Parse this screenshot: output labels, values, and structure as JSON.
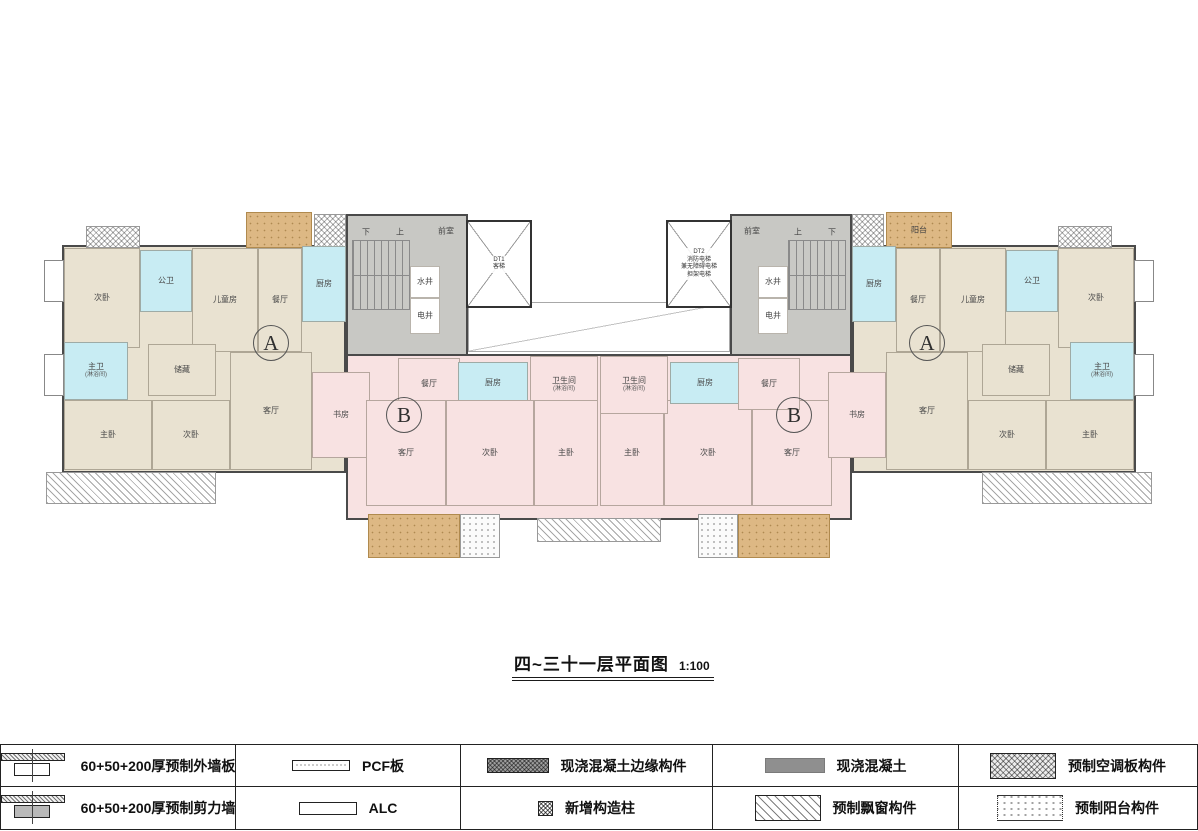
{
  "title": {
    "text": "四~三十一层平面图",
    "scale": "1:100"
  },
  "colors": {
    "beige": "#e9e2d1",
    "pink": "#f8e2e2",
    "cyan": "#c8ecf3",
    "gray": "#c8c8c4",
    "tan": "#ddb884",
    "white": "#ffffff",
    "wall": "#4a4a4a"
  },
  "plan": {
    "zones": [
      {
        "x": 62,
        "y": 245,
        "w": 284,
        "h": 228,
        "fill": "beige"
      },
      {
        "x": 852,
        "y": 245,
        "w": 284,
        "h": 228,
        "fill": "beige"
      },
      {
        "x": 346,
        "y": 214,
        "w": 122,
        "h": 146,
        "fill": "gray"
      },
      {
        "x": 730,
        "y": 214,
        "w": 122,
        "h": 146,
        "fill": "gray"
      },
      {
        "x": 346,
        "y": 354,
        "w": 506,
        "h": 166,
        "fill": "pink"
      }
    ],
    "rooms": [
      {
        "label": "次卧",
        "x": 64,
        "y": 248,
        "w": 76,
        "h": 100,
        "fill": "beige"
      },
      {
        "label": "公卫",
        "x": 140,
        "y": 250,
        "w": 52,
        "h": 62,
        "fill": "cyan"
      },
      {
        "label": "儿童房",
        "x": 192,
        "y": 248,
        "w": 66,
        "h": 104,
        "fill": "beige"
      },
      {
        "label": "餐厅",
        "x": 258,
        "y": 248,
        "w": 44,
        "h": 104,
        "fill": "beige"
      },
      {
        "label": "厨房",
        "x": 302,
        "y": 246,
        "w": 44,
        "h": 76,
        "fill": "cyan"
      },
      {
        "label": "主卫",
        "sub": "(淋浴间)",
        "x": 64,
        "y": 342,
        "w": 64,
        "h": 58,
        "fill": "cyan"
      },
      {
        "label": "储藏",
        "x": 148,
        "y": 344,
        "w": 68,
        "h": 52,
        "fill": "beige"
      },
      {
        "label": "主卧",
        "x": 64,
        "y": 400,
        "w": 88,
        "h": 70,
        "fill": "beige"
      },
      {
        "label": "次卧",
        "x": 152,
        "y": 400,
        "w": 78,
        "h": 70,
        "fill": "beige"
      },
      {
        "label": "客厅",
        "x": 230,
        "y": 352,
        "w": 82,
        "h": 118,
        "fill": "beige"
      },
      {
        "label": "书房",
        "x": 312,
        "y": 372,
        "w": 58,
        "h": 86,
        "fill": "pink"
      },
      {
        "label": "餐厅",
        "x": 398,
        "y": 358,
        "w": 62,
        "h": 52,
        "fill": "pink"
      },
      {
        "label": "厨房",
        "x": 458,
        "y": 362,
        "w": 70,
        "h": 42,
        "fill": "cyan"
      },
      {
        "label": "卫生间",
        "sub": "(淋浴间)",
        "x": 530,
        "y": 356,
        "w": 68,
        "h": 58,
        "fill": "pink"
      },
      {
        "label": "客厅",
        "x": 366,
        "y": 400,
        "w": 80,
        "h": 106,
        "fill": "pink"
      },
      {
        "label": "次卧",
        "x": 446,
        "y": 400,
        "w": 88,
        "h": 106,
        "fill": "pink"
      },
      {
        "label": "主卧",
        "x": 534,
        "y": 400,
        "w": 64,
        "h": 106,
        "fill": "pink"
      },
      {
        "label": "主卧",
        "x": 600,
        "y": 400,
        "w": 64,
        "h": 106,
        "fill": "pink"
      },
      {
        "label": "次卧",
        "x": 664,
        "y": 400,
        "w": 88,
        "h": 106,
        "fill": "pink"
      },
      {
        "label": "客厅",
        "x": 752,
        "y": 400,
        "w": 80,
        "h": 106,
        "fill": "pink"
      },
      {
        "label": "卫生间",
        "sub": "(淋浴间)",
        "x": 600,
        "y": 356,
        "w": 68,
        "h": 58,
        "fill": "pink"
      },
      {
        "label": "厨房",
        "x": 670,
        "y": 362,
        "w": 70,
        "h": 42,
        "fill": "cyan"
      },
      {
        "label": "餐厅",
        "x": 738,
        "y": 358,
        "w": 62,
        "h": 52,
        "fill": "pink"
      },
      {
        "label": "书房",
        "x": 828,
        "y": 372,
        "w": 58,
        "h": 86,
        "fill": "pink"
      },
      {
        "label": "厨房",
        "x": 852,
        "y": 246,
        "w": 44,
        "h": 76,
        "fill": "cyan"
      },
      {
        "label": "餐厅",
        "x": 896,
        "y": 248,
        "w": 44,
        "h": 104,
        "fill": "beige"
      },
      {
        "label": "儿童房",
        "x": 940,
        "y": 248,
        "w": 66,
        "h": 104,
        "fill": "beige"
      },
      {
        "label": "公卫",
        "x": 1006,
        "y": 250,
        "w": 52,
        "h": 62,
        "fill": "cyan"
      },
      {
        "label": "次卧",
        "x": 1058,
        "y": 248,
        "w": 76,
        "h": 100,
        "fill": "beige"
      },
      {
        "label": "客厅",
        "x": 886,
        "y": 352,
        "w": 82,
        "h": 118,
        "fill": "beige"
      },
      {
        "label": "储藏",
        "x": 982,
        "y": 344,
        "w": 68,
        "h": 52,
        "fill": "beige"
      },
      {
        "label": "主卫",
        "sub": "(淋浴间)",
        "x": 1070,
        "y": 342,
        "w": 64,
        "h": 58,
        "fill": "cyan"
      },
      {
        "label": "次卧",
        "x": 968,
        "y": 400,
        "w": 78,
        "h": 70,
        "fill": "beige"
      },
      {
        "label": "主卧",
        "x": 1046,
        "y": 400,
        "w": 88,
        "h": 70,
        "fill": "beige"
      },
      {
        "label": "水井",
        "x": 410,
        "y": 266,
        "w": 30,
        "h": 32,
        "fill": "white"
      },
      {
        "label": "电井",
        "x": 410,
        "y": 298,
        "w": 30,
        "h": 36,
        "fill": "white"
      },
      {
        "label": "水井",
        "x": 758,
        "y": 266,
        "w": 30,
        "h": 32,
        "fill": "white"
      },
      {
        "label": "电井",
        "x": 758,
        "y": 298,
        "w": 30,
        "h": 36,
        "fill": "white"
      }
    ],
    "patches": [
      {
        "type": "stairs",
        "x": 352,
        "y": 240,
        "w": 58,
        "h": 70
      },
      {
        "type": "stairs",
        "x": 788,
        "y": 240,
        "w": 58,
        "h": 70
      },
      {
        "type": "lightwell",
        "x": 468,
        "y": 302,
        "w": 262,
        "h": 50
      },
      {
        "type": "balcony-tan",
        "x": 246,
        "y": 212,
        "w": 66,
        "h": 36
      },
      {
        "type": "balcony-tan",
        "x": 886,
        "y": 212,
        "w": 66,
        "h": 36
      },
      {
        "type": "balcony-tan",
        "x": 368,
        "y": 514,
        "w": 92,
        "h": 44
      },
      {
        "type": "balcony-tan",
        "x": 738,
        "y": 514,
        "w": 92,
        "h": 44
      },
      {
        "type": "dots-white",
        "x": 460,
        "y": 514,
        "w": 40,
        "h": 44
      },
      {
        "type": "dots-white",
        "x": 698,
        "y": 514,
        "w": 40,
        "h": 44
      },
      {
        "type": "crosshatch",
        "x": 86,
        "y": 226,
        "w": 54,
        "h": 22
      },
      {
        "type": "crosshatch",
        "x": 1058,
        "y": 226,
        "w": 54,
        "h": 22
      },
      {
        "type": "crosshatch",
        "x": 314,
        "y": 214,
        "w": 32,
        "h": 34
      },
      {
        "type": "crosshatch",
        "x": 852,
        "y": 214,
        "w": 32,
        "h": 34
      },
      {
        "type": "bay",
        "x": 44,
        "y": 260,
        "w": 20,
        "h": 42
      },
      {
        "type": "bay",
        "x": 44,
        "y": 354,
        "w": 20,
        "h": 42
      },
      {
        "type": "bay",
        "x": 1134,
        "y": 260,
        "w": 20,
        "h": 42
      },
      {
        "type": "bay",
        "x": 1134,
        "y": 354,
        "w": 20,
        "h": 42
      },
      {
        "type": "diag",
        "x": 46,
        "y": 472,
        "w": 170,
        "h": 32
      },
      {
        "type": "diag",
        "x": 982,
        "y": 472,
        "w": 170,
        "h": 32
      },
      {
        "type": "diag",
        "x": 537,
        "y": 518,
        "w": 124,
        "h": 24
      }
    ],
    "elevators": [
      {
        "x": 466,
        "y": 220,
        "w": 66,
        "h": 88,
        "lines": [
          "DT1",
          "客梯"
        ]
      },
      {
        "x": 666,
        "y": 220,
        "w": 66,
        "h": 88,
        "lines": [
          "DT2",
          "消防电梯",
          "兼无障碍电梯",
          "担架电梯"
        ]
      }
    ],
    "labels": [
      {
        "text": "前室",
        "x": 446,
        "y": 231
      },
      {
        "text": "前室",
        "x": 752,
        "y": 231
      },
      {
        "text": "下",
        "x": 366,
        "y": 232
      },
      {
        "text": "上",
        "x": 400,
        "y": 232
      },
      {
        "text": "上",
        "x": 798,
        "y": 232
      },
      {
        "text": "下",
        "x": 832,
        "y": 232
      },
      {
        "text": "阳台",
        "x": 919,
        "y": 230
      }
    ],
    "units": [
      {
        "letter": "A",
        "cx": 271,
        "cy": 343
      },
      {
        "letter": "A",
        "cx": 927,
        "cy": 343
      },
      {
        "letter": "B",
        "cx": 404,
        "cy": 415
      },
      {
        "letter": "B",
        "cx": 794,
        "cy": 415
      }
    ]
  },
  "legend": {
    "rows": [
      [
        {
          "icon": "exterior-wall-icon",
          "label": "60+50+200厚预制外墙板"
        },
        {
          "icon": "pcf-bar-icon",
          "label": "PCF板"
        },
        {
          "icon": "edge-hatch-icon",
          "label": "现浇混凝土边缘构件"
        },
        {
          "icon": "concrete-bar-icon",
          "label": "现浇混凝土"
        },
        {
          "icon": "crosshatch-bar-icon",
          "label": "预制空调板构件"
        }
      ],
      [
        {
          "icon": "shear-wall-icon",
          "label": "60+50+200厚预制剪力墙"
        },
        {
          "icon": "alc-bar-icon",
          "label": "ALC"
        },
        {
          "icon": "column-square-icon",
          "label": "新增构造柱"
        },
        {
          "icon": "diag-hatch-bar-icon",
          "label": "预制飘窗构件"
        },
        {
          "icon": "dotted-bar-icon",
          "label": "预制阳台构件"
        }
      ]
    ]
  }
}
